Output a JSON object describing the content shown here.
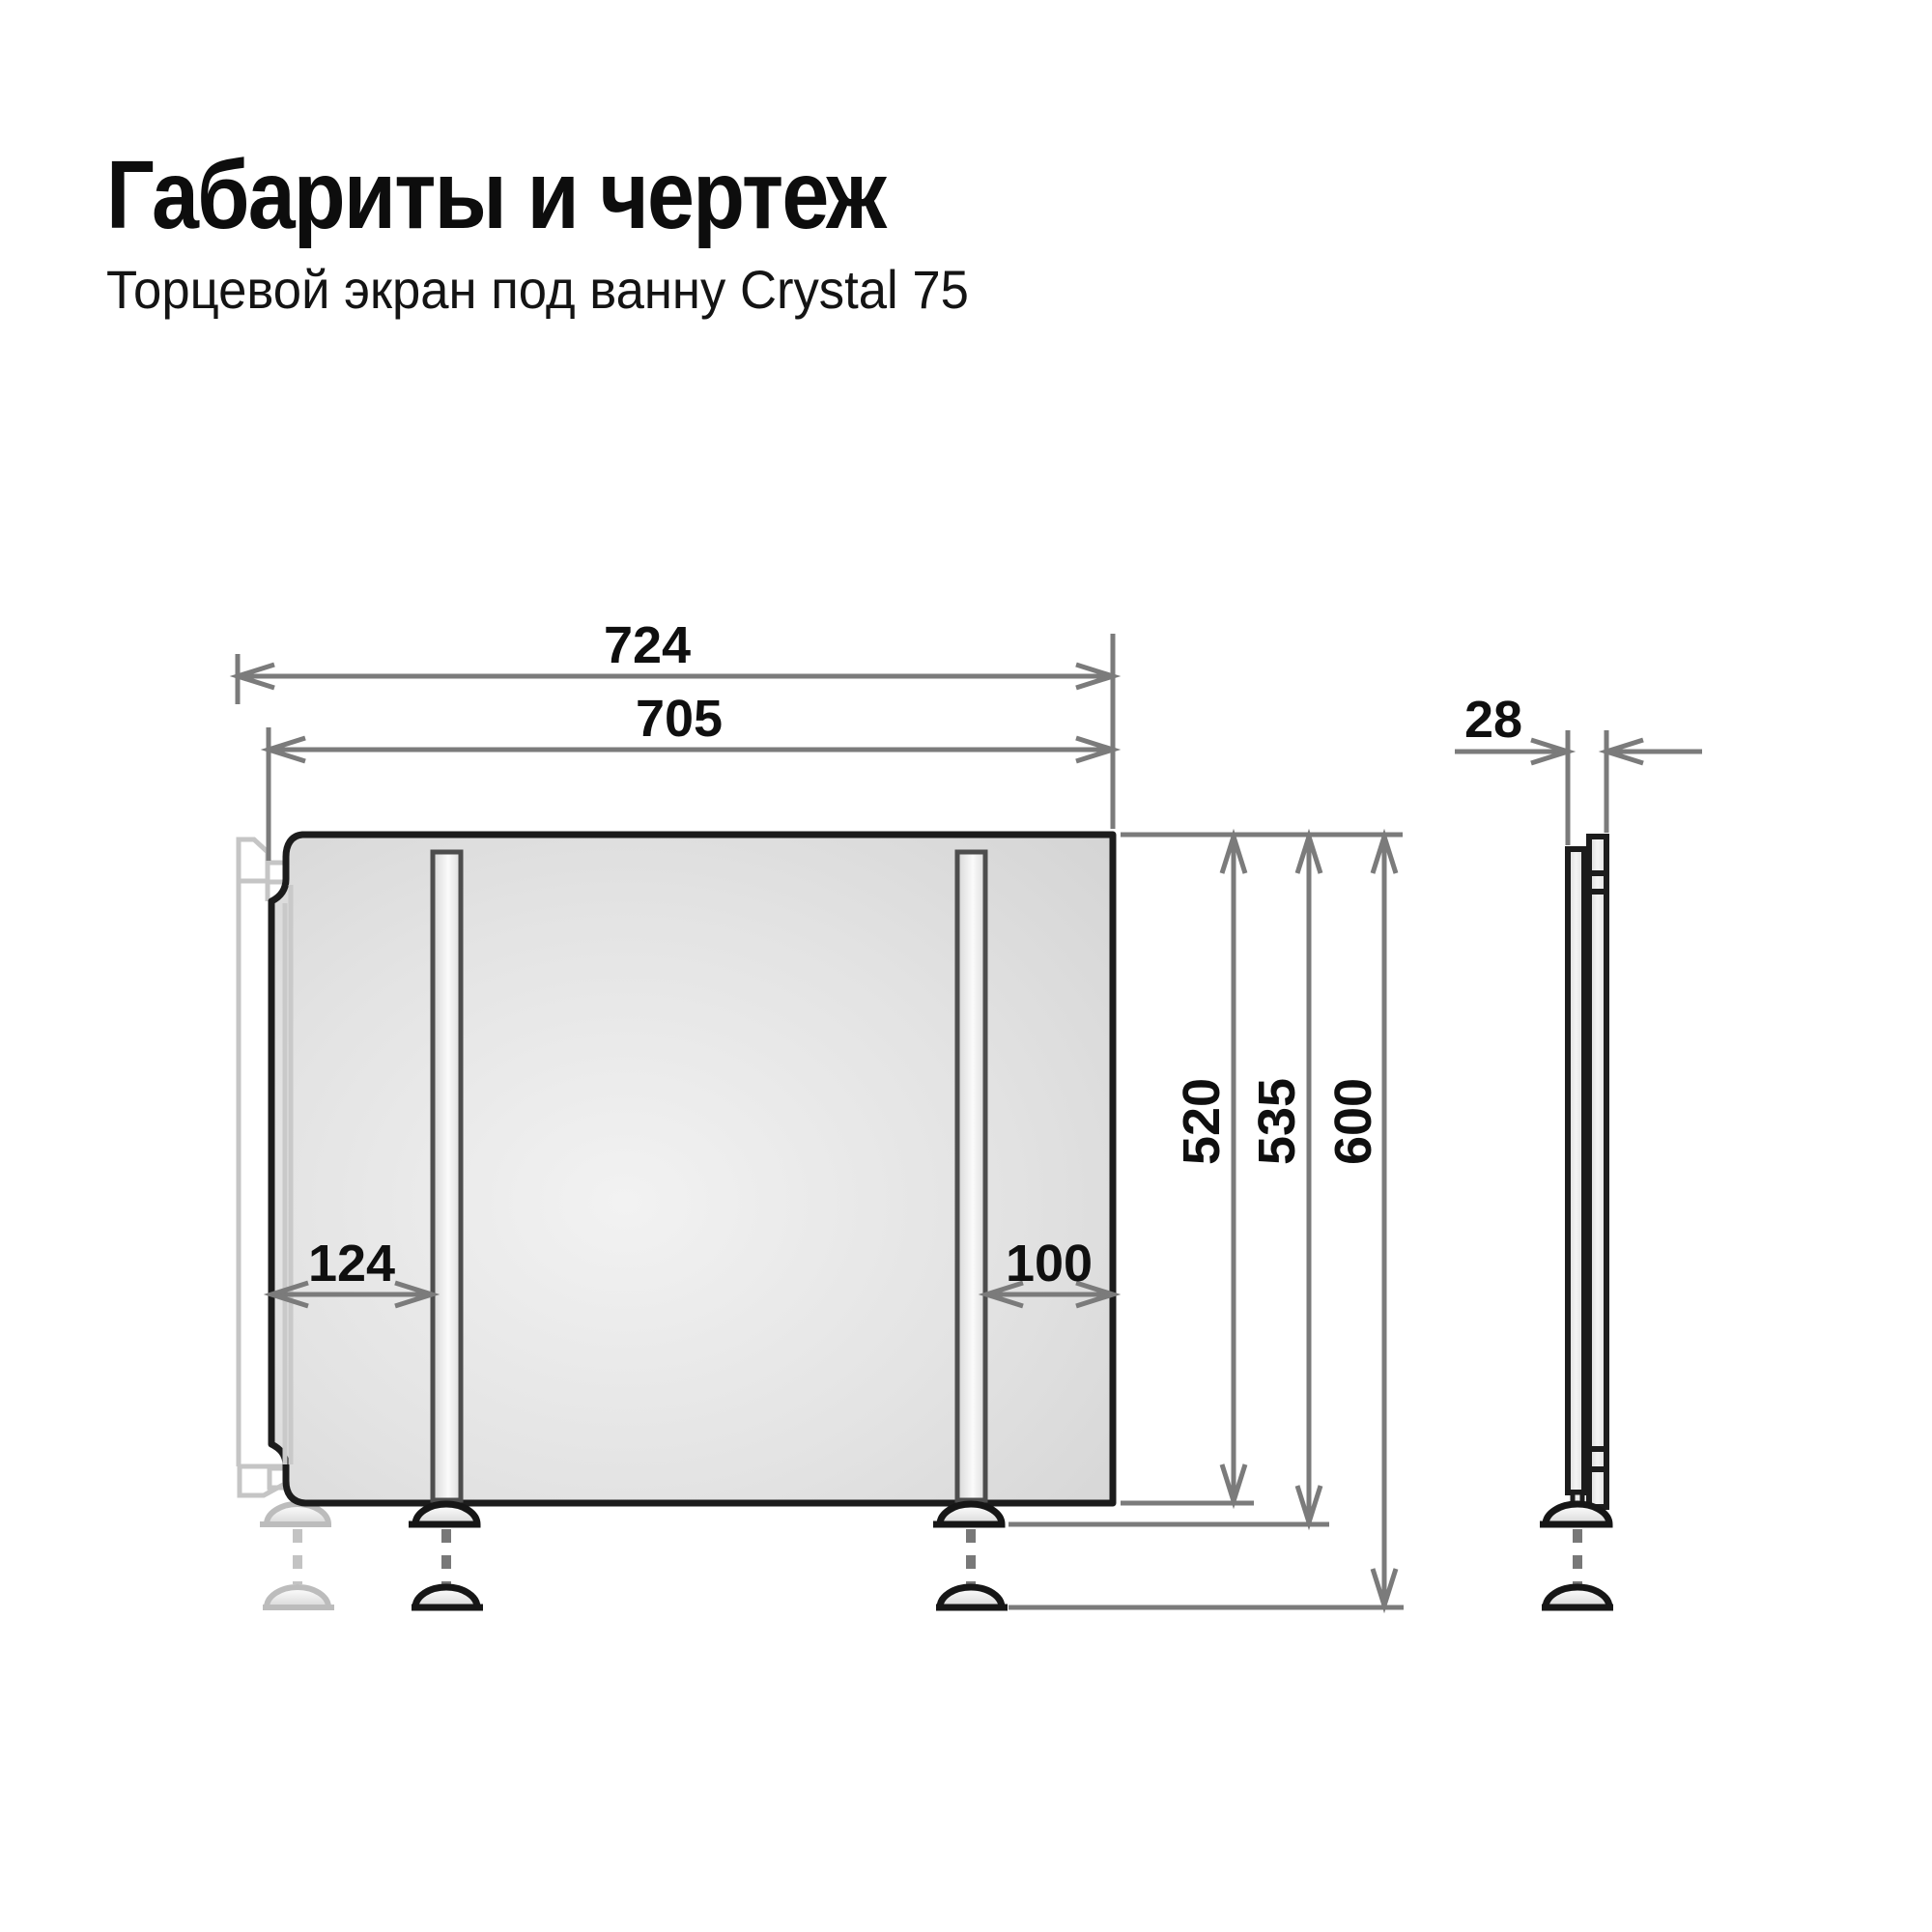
{
  "header": {
    "title": "Габариты и чертеж",
    "subtitle": "Торцевой экран под ванну Crystal 75"
  },
  "drawing": {
    "front_view": {
      "dims": {
        "overall_width": "724",
        "panel_width": "705",
        "left_leg_offset": "124",
        "right_leg_offset": "100",
        "panel_height": "520",
        "height_to_leg_mount": "535",
        "overall_height": "600"
      }
    },
    "side_view": {
      "dims": {
        "thickness": "28"
      }
    },
    "colors": {
      "outline": "#1c1c1c",
      "dimension_line": "#7b7b7b",
      "ghost": "#c5c5c5",
      "panel_fill": "#dedede",
      "text": "#0f0f0f"
    }
  }
}
